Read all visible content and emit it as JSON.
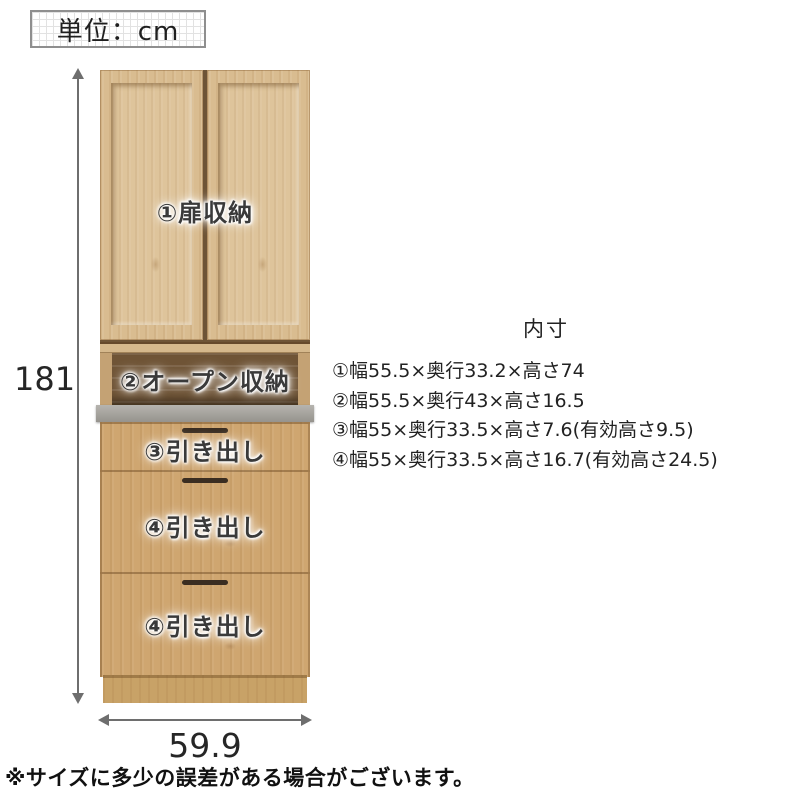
{
  "unit_box": {
    "label": "単位：cm"
  },
  "dimensions": {
    "height": "181",
    "width": "59.9"
  },
  "cabinet": {
    "labels": {
      "door_storage": "①扉収納",
      "open_storage": "②オープン収納",
      "drawer_3": "③引き出し",
      "drawer_4a": "④引き出し",
      "drawer_4b": "④引き出し"
    }
  },
  "specs": {
    "heading": "内寸",
    "items": [
      "①幅55.5×奥行33.2×高さ74",
      "②幅55.5×奥行43×高さ16.5",
      "③幅55×奥行33.5×高さ7.6(有効高さ9.5)",
      "④幅55×奥行33.5×高さ16.7(有効高さ24.5)"
    ]
  },
  "footnote": "※サイズに多少の誤差がある場合がございます。",
  "colors": {
    "wood_light": "#d9bc90",
    "wood_panel": "#dec49b",
    "wood_drawer": "#cfa670",
    "interior_dark": "#6f5436",
    "counter_gray": "#a7a49e",
    "handle_dark": "#3a2d21",
    "dimension_gray": "#6e6e6e",
    "text_dark": "#2b2b2b"
  }
}
